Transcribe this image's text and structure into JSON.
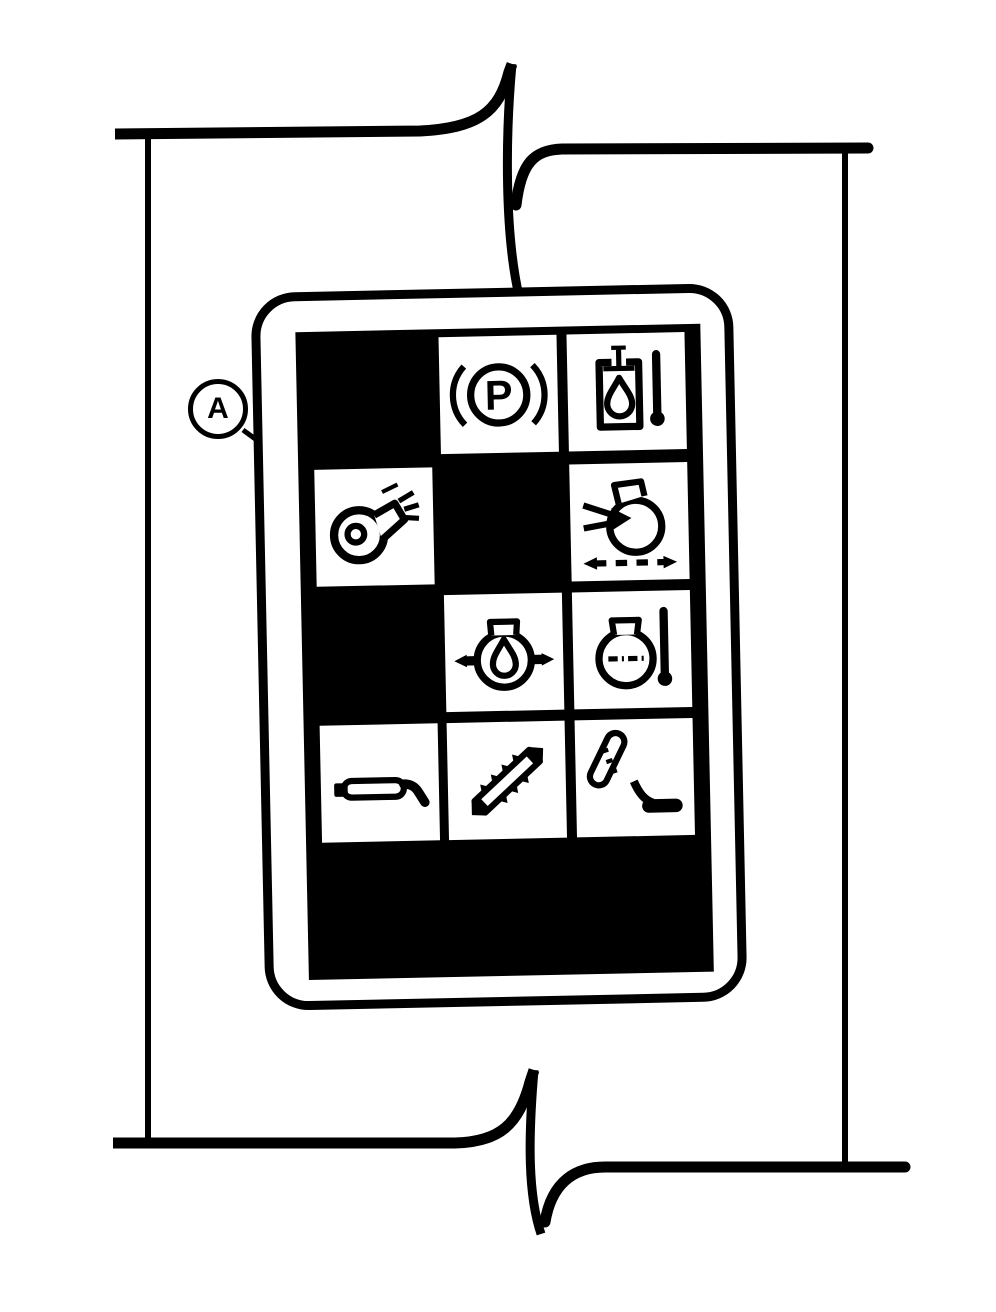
{
  "figure": {
    "kind": "instrument-panel-warning-symbol-grid"
  },
  "callout": {
    "label": "A",
    "points_to": "air-blower-cell"
  },
  "colors": {
    "ink": "#000000",
    "paper": "#ffffff"
  },
  "panel": {
    "icons": {
      "parking_brake_letter": "P"
    },
    "grid": {
      "rows": 4,
      "cols": 3,
      "cells": [
        {
          "row": 1,
          "col": 1,
          "state": "dark",
          "icon": null
        },
        {
          "row": 1,
          "col": 2,
          "state": "lit",
          "icon": "parking-brake-icon"
        },
        {
          "row": 1,
          "col": 3,
          "state": "lit",
          "icon": "oil-level-temperature-icon"
        },
        {
          "row": 2,
          "col": 1,
          "state": "lit",
          "icon": "air-blower-icon"
        },
        {
          "row": 2,
          "col": 2,
          "state": "dark",
          "icon": null
        },
        {
          "row": 2,
          "col": 3,
          "state": "lit",
          "icon": "oil-flow-icon"
        },
        {
          "row": 3,
          "col": 1,
          "state": "dark",
          "icon": null
        },
        {
          "row": 3,
          "col": 2,
          "state": "lit",
          "icon": "oil-pressure-icon"
        },
        {
          "row": 3,
          "col": 3,
          "state": "lit",
          "icon": "oil-temperature-icon"
        },
        {
          "row": 4,
          "col": 1,
          "state": "lit",
          "icon": "cutterbar-icon"
        },
        {
          "row": 4,
          "col": 2,
          "state": "lit",
          "icon": "toothed-bar-icon"
        },
        {
          "row": 4,
          "col": 3,
          "state": "lit",
          "icon": "unloading-tube-icon"
        }
      ]
    }
  }
}
